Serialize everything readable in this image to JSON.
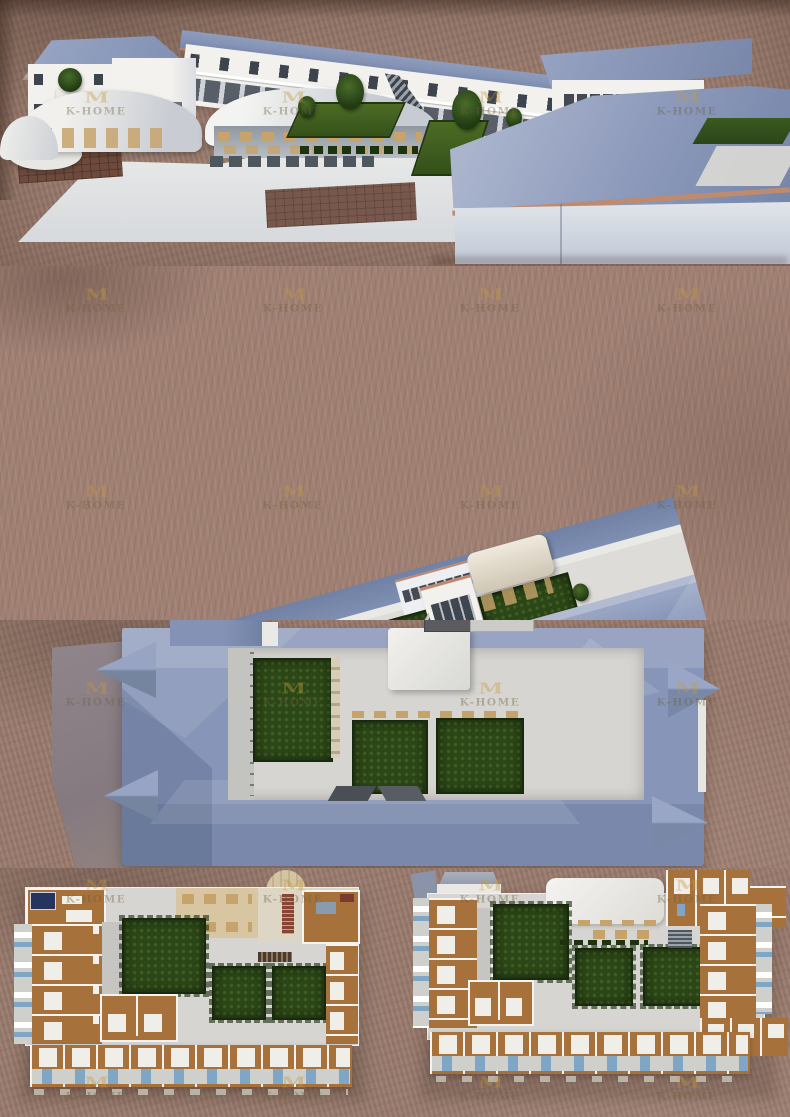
{
  "watermark": {
    "logo_glyph": "M",
    "text": "K-HOME"
  },
  "watermark_layout": {
    "cols": [
      96,
      293,
      490,
      687
    ],
    "rows": [
      105,
      302,
      499,
      696,
      893,
      1090
    ]
  },
  "colors": {
    "ground": "#9c7d70",
    "ground_dark": "#7a5f55",
    "ground_light": "#ad8d7e",
    "roof_blue": "#8494b6",
    "roof_light": "#a3aecb",
    "roof_mid": "#8795b8",
    "roof_dark": "#6b7a9e",
    "roof_deep": "#57668c",
    "wall_white": "#f2f1ee",
    "wall_shade": "#dcdfe5",
    "window_dark": "#3e444d",
    "trim": "#c08a6e",
    "concrete": "#e7e7e4",
    "concrete_shade": "#cfd2d6",
    "lawn": "#41601f",
    "garden": "#2c4717",
    "garden_edge": "#182a0d",
    "plan_floor": "#d6d5d1",
    "corridor": "#c6c5c1",
    "wood": "#a7713c",
    "wood_light": "#ba8750",
    "tan": "#d8c6a2",
    "table_tan": "#c7a36c",
    "bed_white": "#efeee9",
    "bath_gray": "#cfcfcc",
    "fixture_blue": "#7fa6c5",
    "navy": "#26355e",
    "stair_red": "#8a4434",
    "grill_dark": "#4e3a2a",
    "apron": "#8d8288",
    "wm_gold": "#c49a3e",
    "wm_text": "#6e5f3c"
  }
}
